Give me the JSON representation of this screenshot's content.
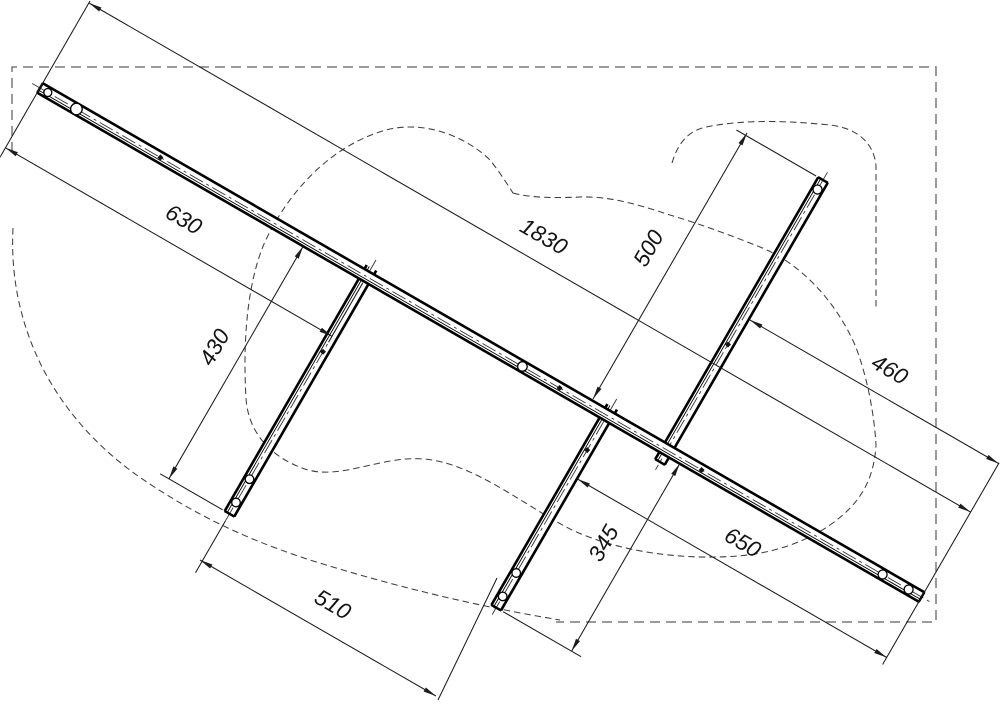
{
  "drawing": {
    "title": "Rail frame assembly drawing",
    "dimensions": {
      "d1830": "1830",
      "d630": "630",
      "d500": "500",
      "d460": "460",
      "d430": "430",
      "d345": "345",
      "d650": "650",
      "d510": "510"
    },
    "colors": {
      "background": "#ffffff",
      "rail_line": "#000000",
      "dimension_line": "#1c1c1c",
      "dashed_outline": "#3f3f3f",
      "boundary_box": "#7a7a7a"
    }
  }
}
